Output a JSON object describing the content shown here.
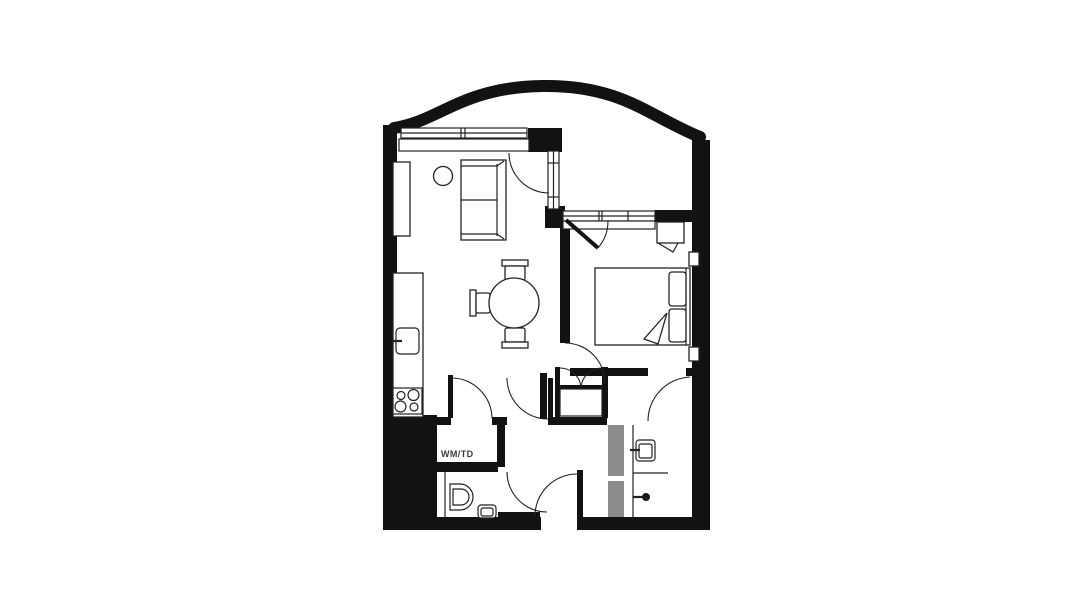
{
  "plan": {
    "utility_label": "WM/TD",
    "colors": {
      "background": "#ffffff",
      "wall": "#121212",
      "line": "#222222",
      "shower_screen": "#8c8c8c",
      "label_text": "#3a3a3a"
    },
    "symbols": [
      "sofa-icon",
      "side-table-icon",
      "shelf-unit-icon",
      "kitchen-counter-icon",
      "kitchen-sink-icon",
      "stove-icon",
      "dining-table-icon",
      "chair-icon",
      "double-bed-icon",
      "pillow-icon",
      "nightstand-icon",
      "wardrobe-icon",
      "toilet-icon",
      "washbasin-icon",
      "shower-head-icon",
      "window-icon",
      "door-swing-icon",
      "curved-balcony-wall-icon"
    ]
  }
}
